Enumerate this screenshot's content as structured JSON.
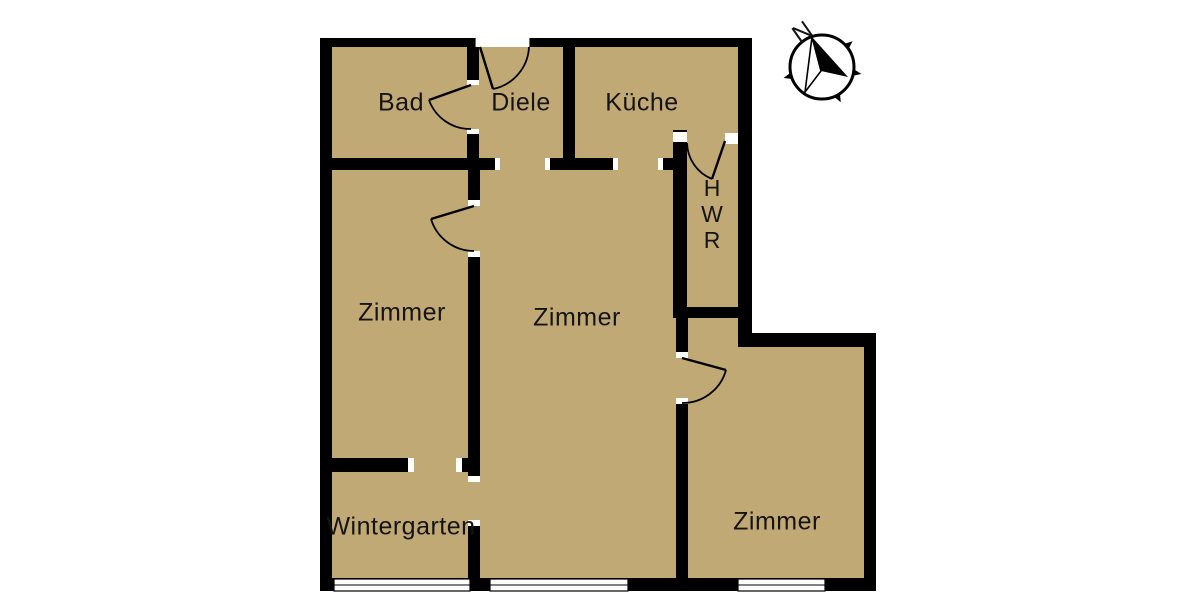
{
  "plan": {
    "rooms": [
      {
        "id": "bad",
        "label": "Bad"
      },
      {
        "id": "diele",
        "label": "Diele"
      },
      {
        "id": "kueche",
        "label": "Küche"
      },
      {
        "id": "hwr",
        "label": "HWR"
      },
      {
        "id": "zimmer_left",
        "label": "Zimmer"
      },
      {
        "id": "zimmer_center",
        "label": "Zimmer"
      },
      {
        "id": "zimmer_right",
        "label": "Zimmer"
      },
      {
        "id": "wintergarten",
        "label": "Wintergarten"
      }
    ],
    "compass": {
      "north_label": "N"
    },
    "colors": {
      "floor": "#c1a975",
      "wall": "#000000",
      "background": "#ffffff",
      "window": "#ffffff",
      "text": "#141414"
    }
  }
}
